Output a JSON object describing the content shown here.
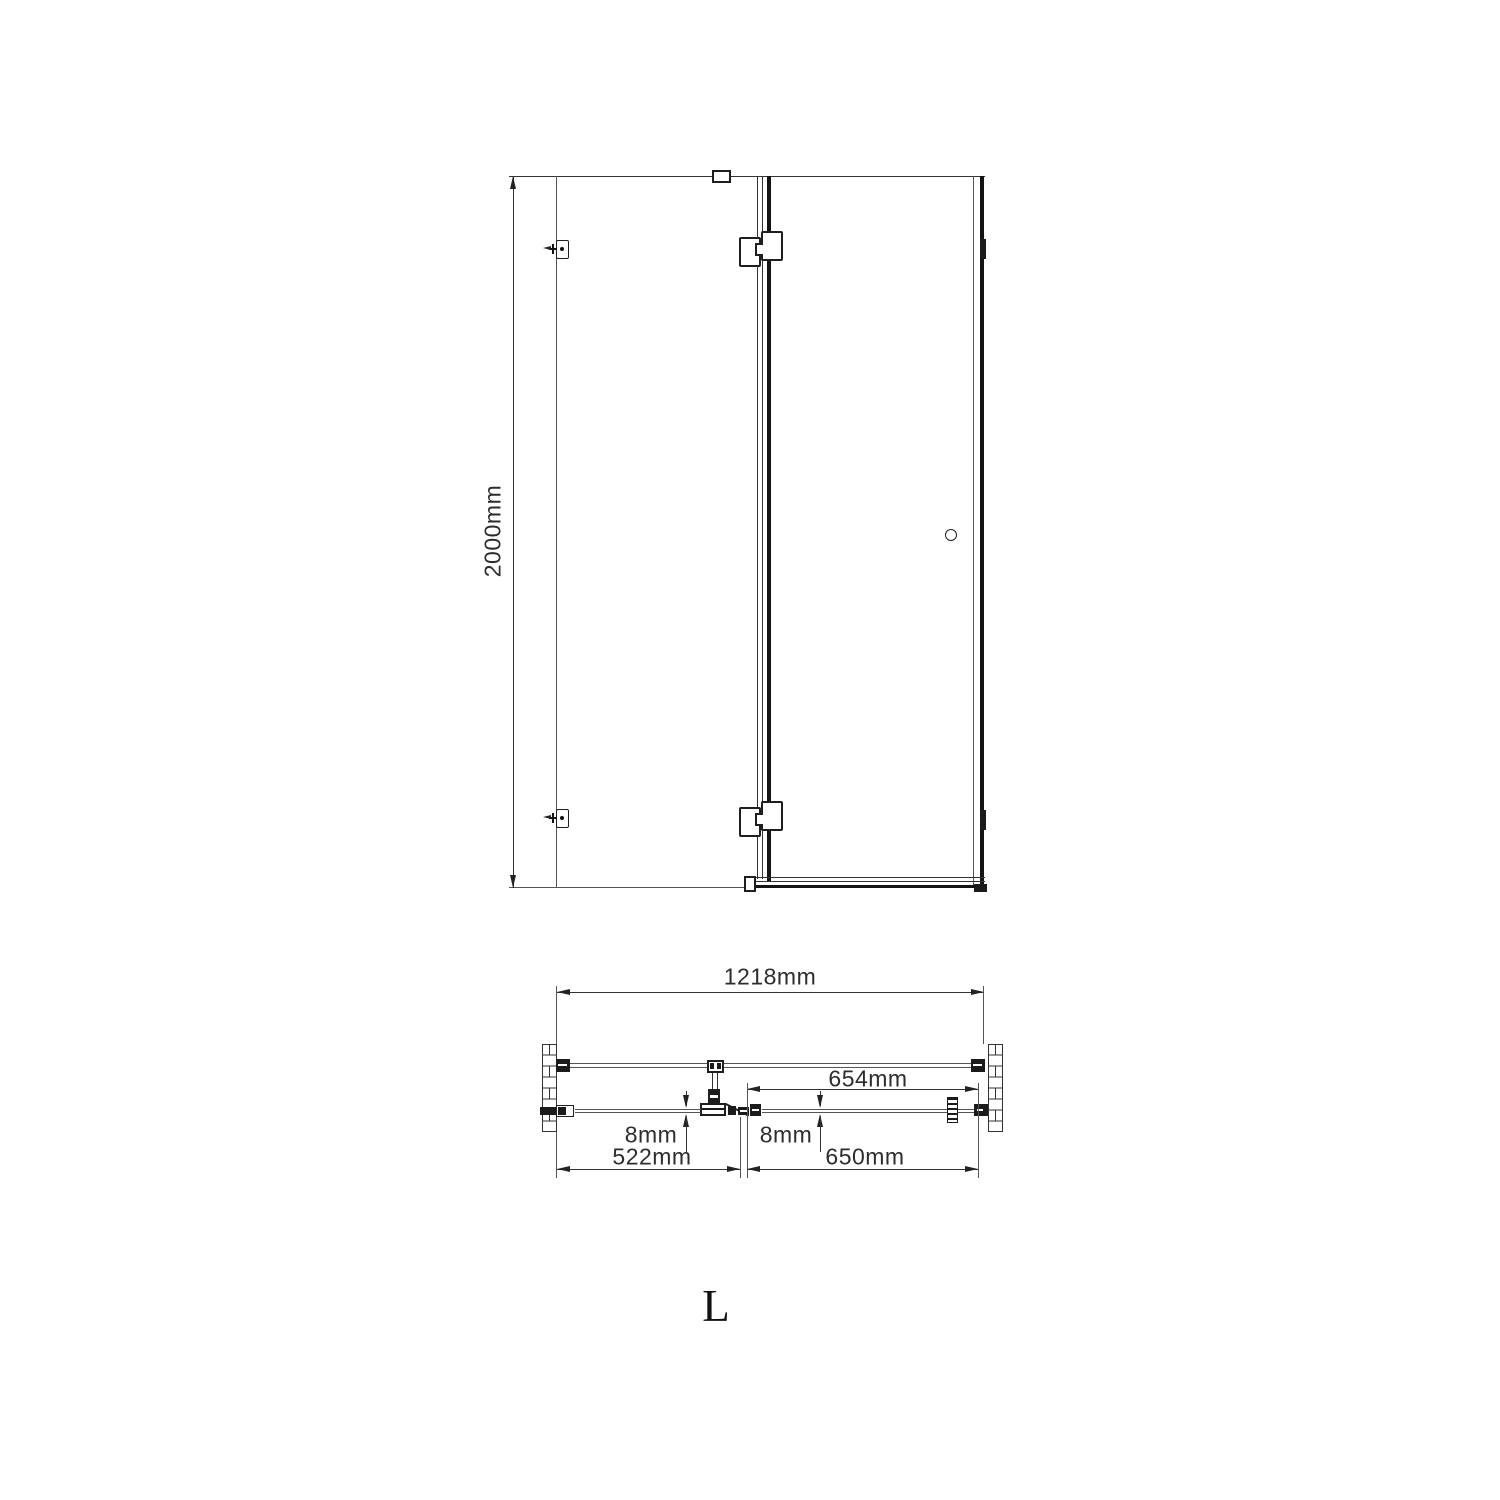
{
  "drawing": {
    "elevation": {
      "height_dim": "2000mm"
    },
    "plan": {
      "overall_width_dim": "1218mm",
      "door_opening_dim": "654mm",
      "fixed_glass_thickness_dim": "8mm",
      "door_glass_thickness_dim": "8mm",
      "fixed_panel_width_dim": "522mm",
      "door_width_dim": "650mm"
    },
    "handing_label": "L",
    "colors": {
      "line_dark": "#111111",
      "line_mid": "#333333",
      "line_thin": "#555555",
      "background": "#ffffff"
    }
  }
}
